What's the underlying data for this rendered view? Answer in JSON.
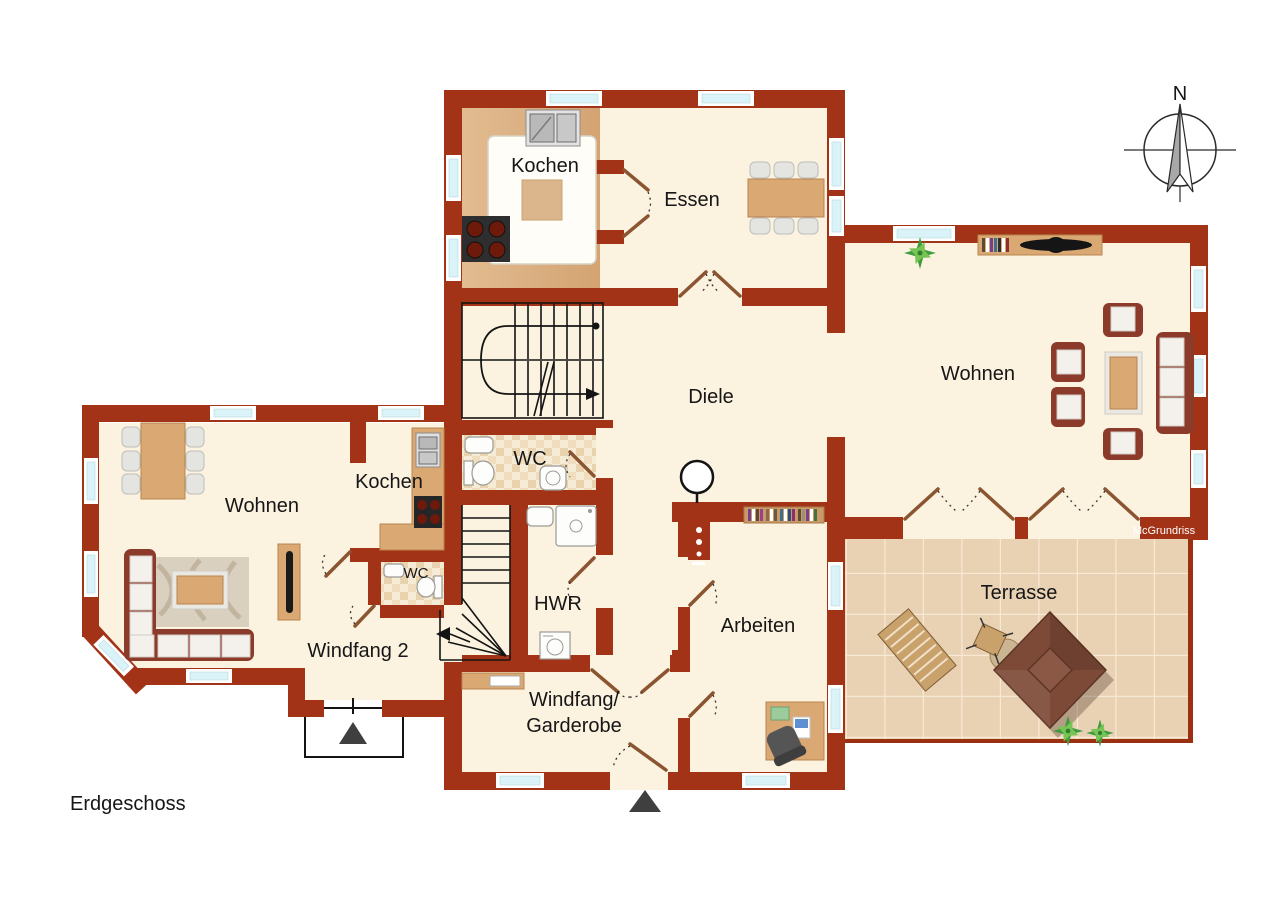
{
  "floor_label": "Erdgeschoss",
  "watermark": "McGrundriss",
  "compass": {
    "north": "N"
  },
  "rooms": {
    "kochen_top": "Kochen",
    "essen": "Essen",
    "wohnen_right": "Wohnen",
    "diele": "Diele",
    "wc_mid": "WC",
    "kochen_left": "Kochen",
    "wohnen_left": "Wohnen",
    "wc_left": "WC",
    "hwr": "HWR",
    "windfang2": "Windfang 2",
    "windfang_garderobe_line1": "Windfang/",
    "windfang_garderobe_line2": "Garderobe",
    "arbeiten": "Arbeiten",
    "terrasse": "Terrasse"
  },
  "colors": {
    "wall": "#A23317",
    "floor": "#FBF2E0",
    "glass": "#D9F3F8",
    "wood": "#D9A873",
    "tile": "#E9D1B3",
    "sofa": "#8C3A2A",
    "label": "#161616"
  }
}
